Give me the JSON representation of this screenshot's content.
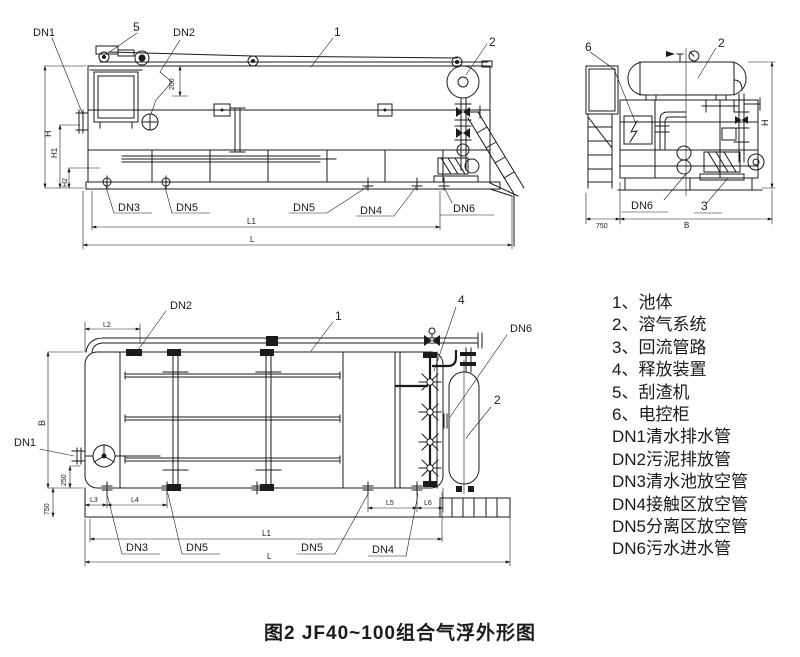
{
  "caption": "图2  JF40~100组合气浮外形图",
  "legend": {
    "items": [
      "1、池体",
      "2、溶气系统",
      "3、回流管路",
      "4、释放装置",
      "5、刮渣机",
      "6、电控柜",
      "DN1清水排水管",
      "DN2污泥排放管",
      "DN3清水池放空管",
      "DN4接触区放空管",
      "DN5分离区放空管",
      "DN6污水进水管"
    ]
  },
  "side_view": {
    "parts": {
      "scraper": "5",
      "tank": "1",
      "air_system": "2"
    },
    "nozzles": {
      "dn1": "DN1",
      "dn2": "DN2",
      "dn3": "DN3",
      "dn5_left": "DN5",
      "dn5_right": "DN5",
      "dn4": "DN4",
      "dn6": "DN6"
    },
    "dims": {
      "h": "H",
      "h1": "H1",
      "h2": "H2",
      "top_offset": "200",
      "l1": "L1",
      "l": "L"
    }
  },
  "end_view": {
    "parts": {
      "cabinet": "6",
      "air_system": "2",
      "return_pipe": "3"
    },
    "nozzles": {
      "dn6": "DN6"
    },
    "dims": {
      "ladder_width": "750",
      "b": "B",
      "h": "H"
    }
  },
  "plan_view": {
    "parts": {
      "tank": "1",
      "release": "4",
      "air_system": "2"
    },
    "nozzles": {
      "dn1": "DN1",
      "dn2": "DN2",
      "dn3": "DN3",
      "dn5_left": "DN5",
      "dn5_right": "DN5",
      "dn4": "DN4",
      "dn6": "DN6"
    },
    "dims": {
      "l2": "L2",
      "b": "B",
      "offset": "250",
      "walkway": "750",
      "l3": "L3",
      "l4": "L4",
      "l5": "L5",
      "l6": "L6",
      "l1": "L1",
      "l": "L"
    }
  },
  "colors": {
    "ink": "#1b1b1b",
    "background": "#ffffff"
  }
}
